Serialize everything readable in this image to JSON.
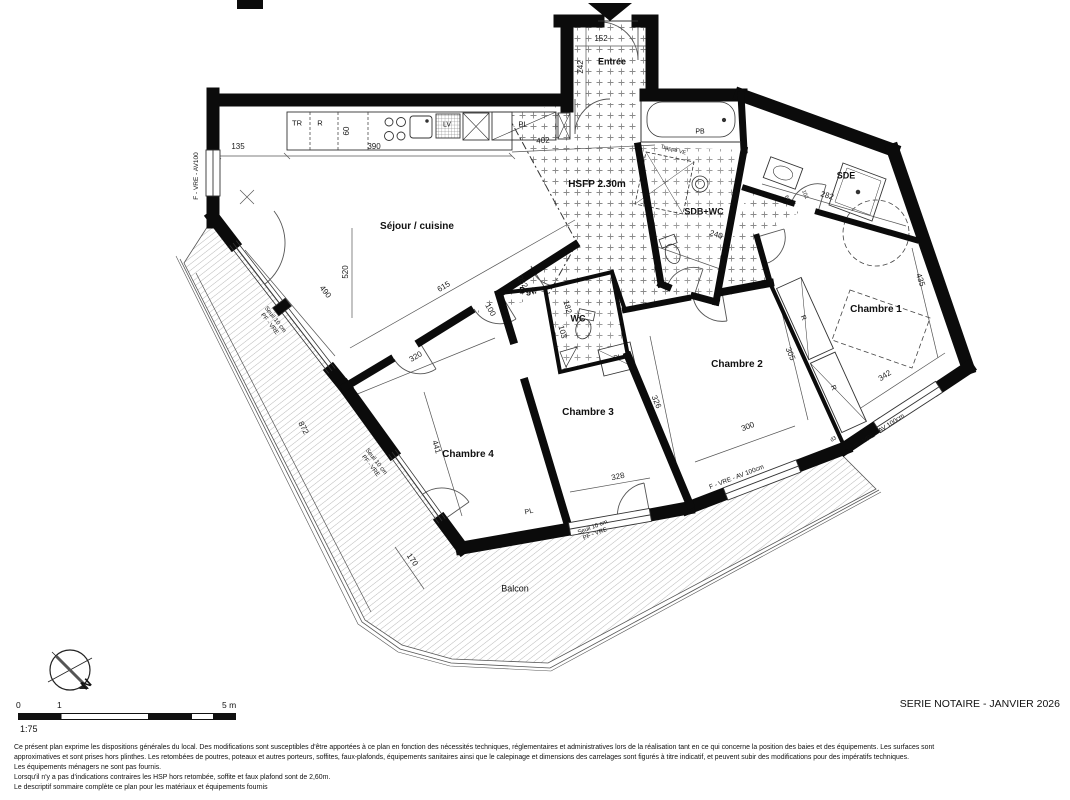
{
  "meta": {
    "series_label": "SERIE NOTAIRE - JANVIER 2026"
  },
  "rooms": {
    "entree": "Entrée",
    "sejour": "Séjour / cuisine",
    "sdb": "SDB+WC",
    "sde": "SDE",
    "chambre1": "Chambre 1",
    "chambre2": "Chambre 2",
    "chambre3": "Chambre 3",
    "chambre4": "Chambre 4",
    "degagement": "Dgt.",
    "wc": "WC",
    "balcon": "Balcon"
  },
  "ceiling": {
    "hsfp": "HSFP 2.30m"
  },
  "fixtures": {
    "tr": "TR",
    "fridge": "R",
    "dishwasher": "LV",
    "bath_panel": "PB",
    "closet": "PL",
    "storage": "R",
    "hatch": "Trappe VE"
  },
  "joinery": {
    "window_left": "F - VRE - AV100",
    "window_standard": "F - VRE - AV 100cm",
    "threshold_line1": "Seuil 10 cm",
    "threshold_line2": "PF - VRE",
    "door_ref": "d3"
  },
  "dimensions": {
    "kitchen_left": "135",
    "kitchen_counter": "390",
    "kitchen_hall": "402",
    "counter_depth": "60",
    "entree_width": "152",
    "entree_depth": "242",
    "sejour_diag": "615",
    "sejour_left": "520",
    "sejour_bay": "490",
    "ch4_top": "320",
    "ch4_diag": "441",
    "ch3_width": "328",
    "ch3_depth": "326",
    "ch2_width": "300",
    "ch2_depth": "305",
    "ch1_width": "342",
    "ch1_depth": "435",
    "sdb_width": "240",
    "sde_width": "282",
    "sde_small_a": "60",
    "sde_small_b": "101",
    "dgt_diag": "282",
    "dgt_width": "100",
    "wc_depth": "182",
    "wc_width": "103",
    "balcon_length": "872",
    "balcon_end": "170"
  },
  "compass": {
    "north": "N"
  },
  "scalebar": {
    "tick0": "0",
    "tick1": "1",
    "tick5": "5 m",
    "ratio": "1:75"
  },
  "notes": {
    "lines": [
      "Ce présent plan exprime les dispositions générales du local. Des modifications sont susceptibles d'être apportées à ce plan en fonction des nécessités techniques, réglementaires et administratives lors de la réalisation tant en ce qui concerne la position des baies et des équipements. Les surfaces sont",
      "approximatives et sont prises hors plinthes. Les retombées de poutres, poteaux et autres porteurs, soffites, faux-plafonds, équipements sanitaires ainsi que le calepinage et dimensions des carrelages sont figurés à titre indicatif, et peuvent subir des modifications pour des impératifs techniques.",
      "Les équipements ménagers ne sont pas fournis.",
      "Lorsqu'il n'y a pas d'indications contraires les HSP hors retombée, soffite et faux plafond sont de 2,60m.",
      "Le descriptif sommaire complète ce plan pour les matériaux et équipements fournis"
    ]
  }
}
